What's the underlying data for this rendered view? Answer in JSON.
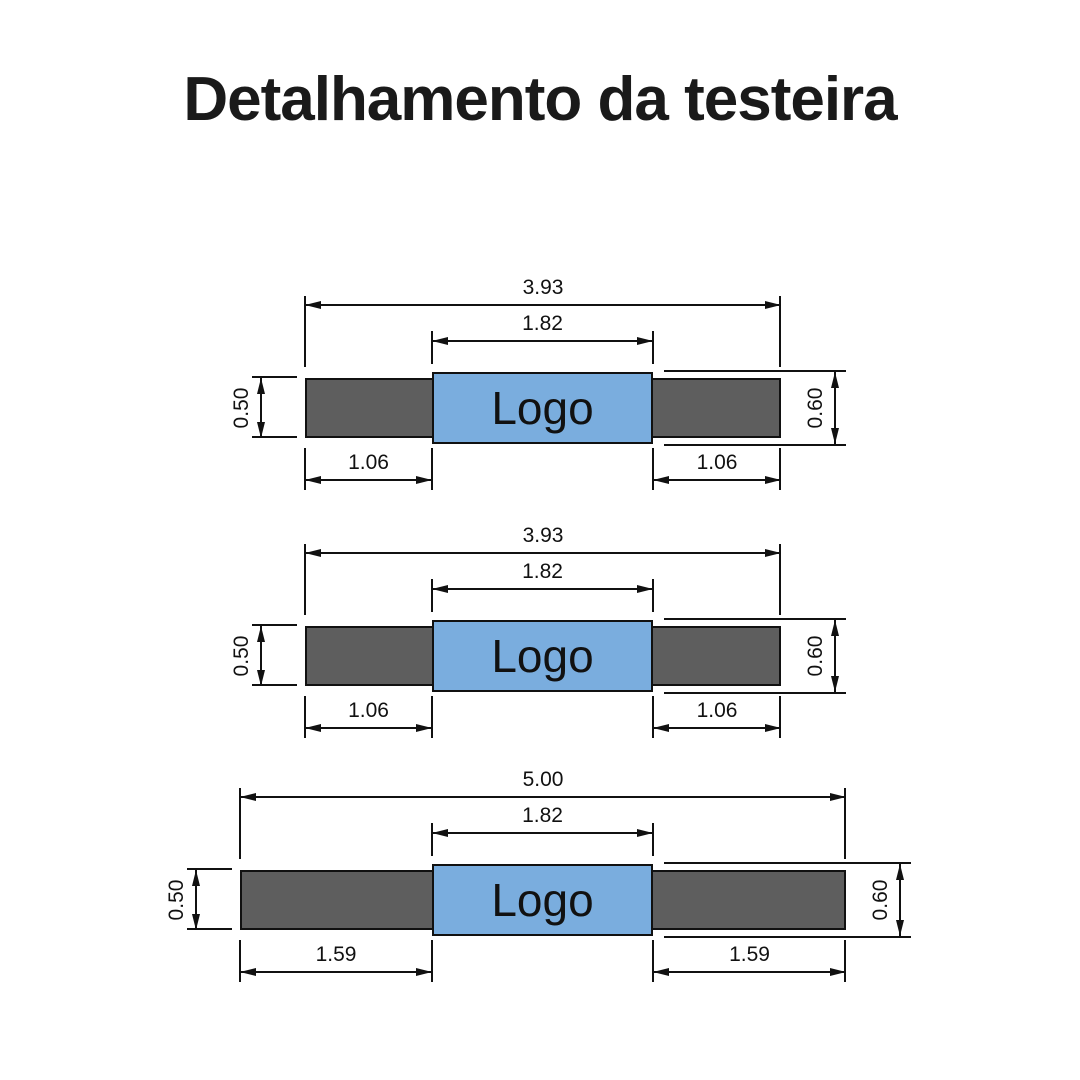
{
  "title": "Detalhamento da testeira",
  "colors": {
    "bar_fill": "#5e5e5e",
    "logo_fill": "#7aadde",
    "line": "#111111"
  },
  "diagrams": [
    {
      "id": "testeira-1",
      "logo_label": "Logo",
      "total_width": "3.93",
      "logo_width": "1.82",
      "bar_height": "0.50",
      "logo_height": "0.60",
      "left_segment": "1.06",
      "right_segment": "1.06"
    },
    {
      "id": "testeira-2",
      "logo_label": "Logo",
      "total_width": "3.93",
      "logo_width": "1.82",
      "bar_height": "0.50",
      "logo_height": "0.60",
      "left_segment": "1.06",
      "right_segment": "1.06"
    },
    {
      "id": "testeira-3",
      "logo_label": "Logo",
      "total_width": "5.00",
      "logo_width": "1.82",
      "bar_height": "0.50",
      "logo_height": "0.60",
      "left_segment": "1.59",
      "right_segment": "1.59"
    }
  ]
}
